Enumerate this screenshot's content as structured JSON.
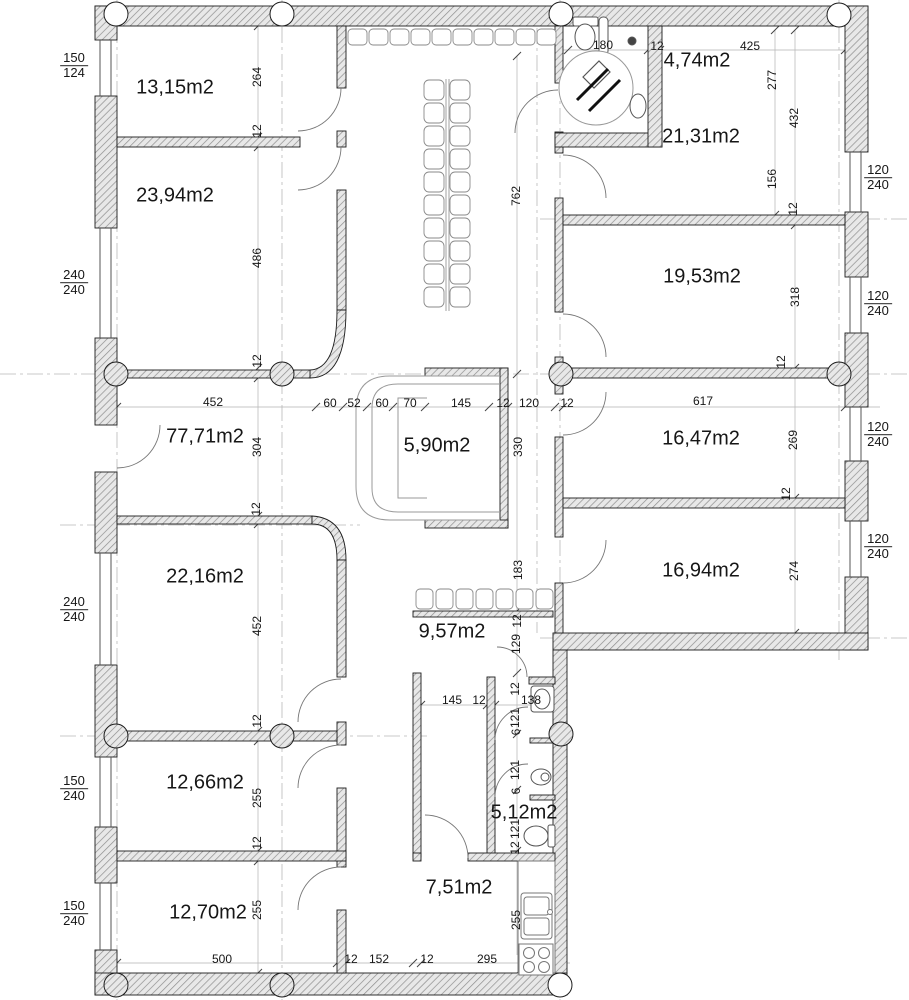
{
  "plan": {
    "drawing_type": "architectural floor plan",
    "unit": "cm",
    "rooms": [
      {
        "area": "13,15m2"
      },
      {
        "area": "23,94m2"
      },
      {
        "area": "4,74m2"
      },
      {
        "area": "21,31m2"
      },
      {
        "area": "19,53m2"
      },
      {
        "area": "77,71m2"
      },
      {
        "area": "5,90m2"
      },
      {
        "area": "16,47m2"
      },
      {
        "area": "16,94m2"
      },
      {
        "area": "22,16m2"
      },
      {
        "area": "9,57m2"
      },
      {
        "area": "12,66m2"
      },
      {
        "area": "12,70m2"
      },
      {
        "area": "5,12m2"
      },
      {
        "area": "7,51m2"
      }
    ],
    "windows_left": [
      {
        "top": "150",
        "bottom": "124"
      },
      {
        "top": "240",
        "bottom": "240"
      },
      {
        "top": "240",
        "bottom": "240"
      },
      {
        "top": "150",
        "bottom": "240"
      },
      {
        "top": "150",
        "bottom": "240"
      }
    ],
    "windows_right": [
      {
        "top": "120",
        "bottom": "240"
      },
      {
        "top": "120",
        "bottom": "240"
      },
      {
        "top": "120",
        "bottom": "240"
      },
      {
        "top": "120",
        "bottom": "240"
      }
    ],
    "dims": {
      "top_chain": [
        "180",
        "12",
        "425"
      ],
      "axis_left": [
        "264",
        "12",
        "486",
        "12",
        "304",
        "12",
        "452",
        "12",
        "255",
        "12",
        "255"
      ],
      "axis_corridor": [
        "762",
        "183",
        "12",
        "129",
        "12",
        "121",
        "6",
        "121",
        "6",
        "121",
        "12",
        "255"
      ],
      "shaft": [
        "330"
      ],
      "axis_right_a": [
        "277",
        "156"
      ],
      "axis_right_b": [
        "432",
        "12",
        "318",
        "12",
        "269",
        "12",
        "274"
      ],
      "mid_chain": [
        "452",
        "60",
        "52",
        "60",
        "70",
        "145",
        "12",
        "120",
        "12",
        "617"
      ],
      "wc_chain": [
        "145",
        "12",
        "138"
      ],
      "bottom_chain": [
        "500",
        "12",
        "152",
        "12",
        "295"
      ]
    }
  }
}
